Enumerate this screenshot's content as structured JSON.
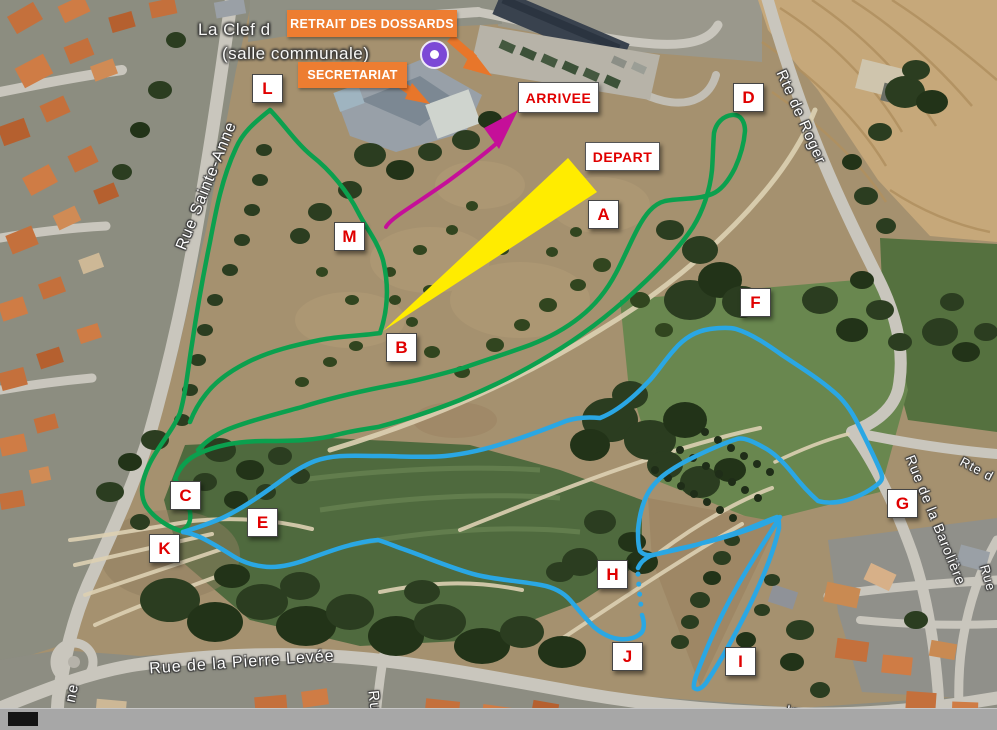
{
  "place": {
    "line1": "La Clef d",
    "line2": "(salle communale)"
  },
  "callouts": {
    "retrait": {
      "label": "RETRAIT DES DOSSARDS"
    },
    "secretariat": {
      "label": "SECRETARIAT"
    }
  },
  "signs": [
    {
      "id": "arrivee",
      "label": "ARRIVEE",
      "x": 518,
      "y": 82,
      "w": 81,
      "h": 31
    },
    {
      "id": "depart",
      "label": "DEPART",
      "x": 585,
      "y": 142,
      "w": 75,
      "h": 29
    }
  ],
  "markers": [
    {
      "letter": "A",
      "x": 588,
      "y": 200
    },
    {
      "letter": "B",
      "x": 386,
      "y": 333
    },
    {
      "letter": "C",
      "x": 170,
      "y": 481
    },
    {
      "letter": "D",
      "x": 733,
      "y": 83
    },
    {
      "letter": "E",
      "x": 247,
      "y": 508
    },
    {
      "letter": "F",
      "x": 740,
      "y": 288
    },
    {
      "letter": "G",
      "x": 887,
      "y": 489
    },
    {
      "letter": "H",
      "x": 597,
      "y": 560
    },
    {
      "letter": "I",
      "x": 725,
      "y": 647
    },
    {
      "letter": "J",
      "x": 612,
      "y": 642
    },
    {
      "letter": "K",
      "x": 149,
      "y": 534
    },
    {
      "letter": "L",
      "x": 252,
      "y": 74
    },
    {
      "letter": "M",
      "x": 334,
      "y": 222
    }
  ],
  "streets": [
    {
      "id": "rue-sainte-anne",
      "name": "Rue Sainte-Anne",
      "x": 207,
      "y": 186,
      "rot": -68,
      "size": 16
    },
    {
      "id": "rte-de-roger",
      "name": "Rte de Roger",
      "x": 801,
      "y": 117,
      "rot": 66,
      "size": 15
    },
    {
      "id": "rue-de-la-pierre-levee",
      "name": "Rue de la Pierre Levée",
      "x": 242,
      "y": 663,
      "rot": -4,
      "size": 16
    },
    {
      "id": "rue-de-la-baroliere",
      "name": "Rue de la Barolière",
      "x": 936,
      "y": 520,
      "rot": 68,
      "size": 14
    },
    {
      "id": "rte-partial",
      "name": "Rte d",
      "x": 977,
      "y": 469,
      "rot": 28,
      "size": 13
    },
    {
      "id": "rue-partial-ne",
      "name": "ne",
      "x": 72,
      "y": 693,
      "rot": -78,
      "size": 15
    },
    {
      "id": "rue-partial-ru",
      "name": "Ru",
      "x": 374,
      "y": 701,
      "rot": 84,
      "size": 15
    },
    {
      "id": "impasse-partial",
      "name": "Imp",
      "x": 800,
      "y": 713,
      "rot": 9,
      "size": 15
    },
    {
      "id": "rue-partial-corner",
      "name": "Rue",
      "x": 988,
      "y": 578,
      "rot": 74,
      "size": 13
    }
  ],
  "legend_colors": {
    "course_green": "#0ba04e",
    "course_blue": "#2aa7e4",
    "finish_chute_magenta": "#c50f99",
    "start_funnel_yellow": "#ffec00",
    "callout_orange": "#ed7d31",
    "marker_letter_red": "#e00000"
  }
}
